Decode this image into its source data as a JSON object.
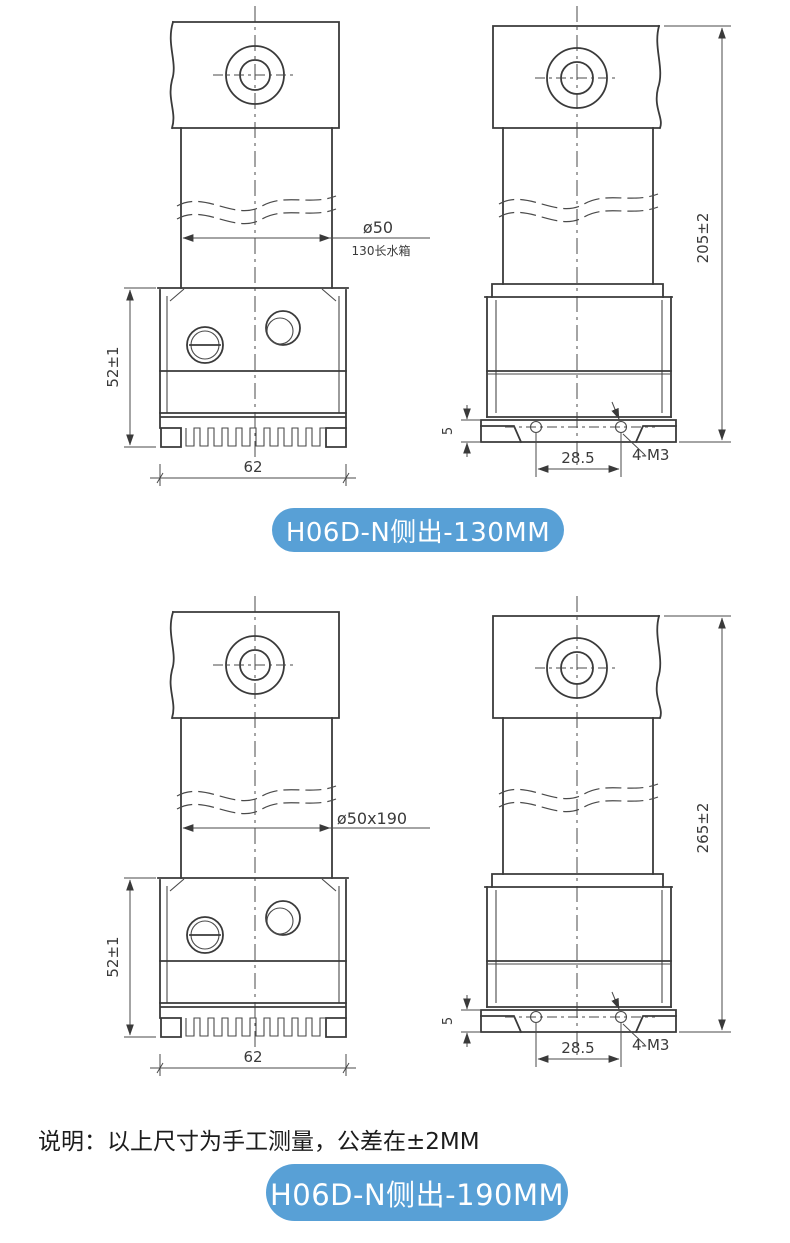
{
  "colors": {
    "badge_background": "#58a0d6",
    "badge_text": "#ffffff",
    "drawing_lines": "#3a3a3a"
  },
  "top": {
    "badge": "H06D-N侧出-130MM",
    "front": {
      "dia": "ø50",
      "dia_note": "130长水箱",
      "head_height": "52±1",
      "head_width": "62"
    },
    "side": {
      "overall": "205±2",
      "flange": "5",
      "holes_span": "28.5",
      "holes": "4-M3"
    }
  },
  "bottom": {
    "badge": "H06D-N侧出-190MM",
    "front": {
      "dia": "ø50x190",
      "head_height": "52±1",
      "head_width": "62"
    },
    "side": {
      "overall": "265±2",
      "flange": "5",
      "holes_span": "28.5",
      "holes": "4-M3"
    }
  },
  "note": "说明：以上尺寸为手工测量，公差在±2MM"
}
